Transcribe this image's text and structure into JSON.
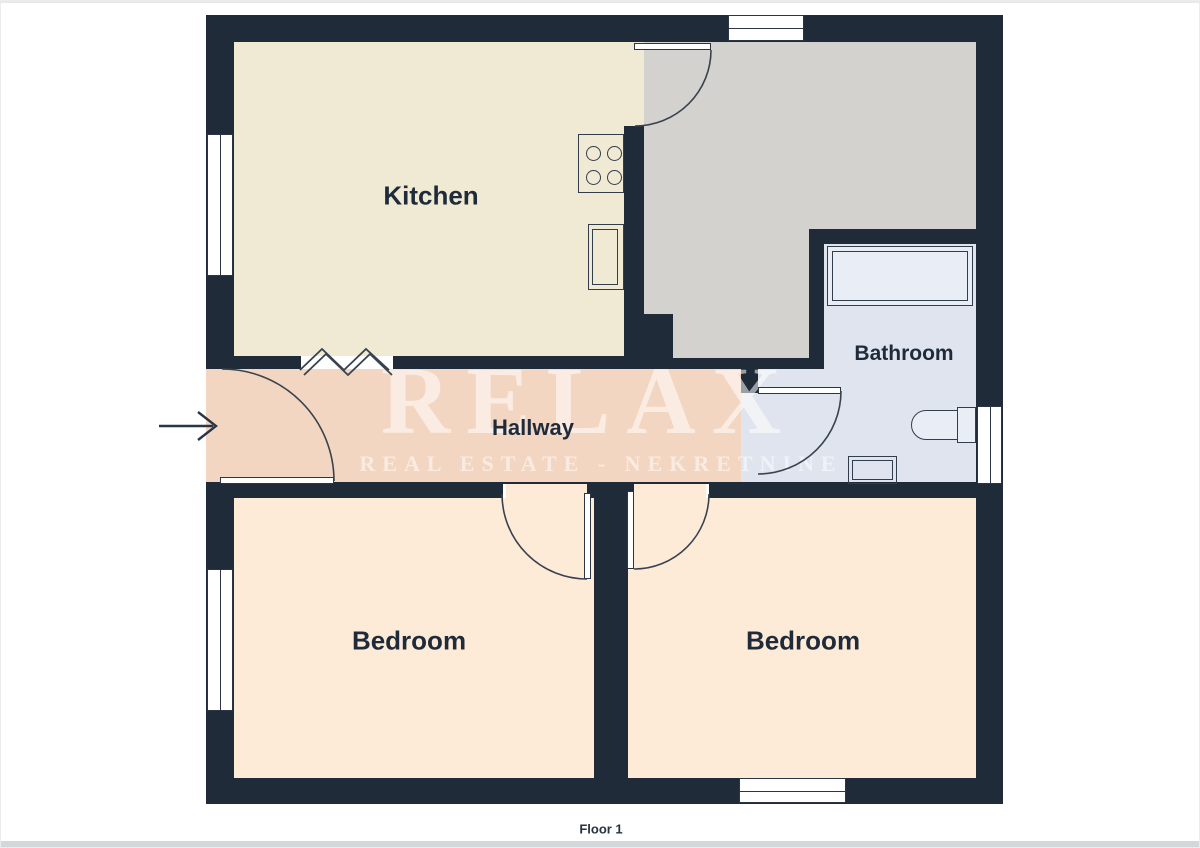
{
  "page": {
    "floor_label": "Floor 1"
  },
  "watermark": {
    "title": "RELAX",
    "subtitle": "REAL ESTATE - NEKRETNINE"
  },
  "rooms": {
    "kitchen": {
      "label": "Kitchen"
    },
    "bathroom": {
      "label": "Bathroom"
    },
    "hallway": {
      "label": "Hallway"
    },
    "bedroom_left": {
      "label": "Bedroom"
    },
    "bedroom_right": {
      "label": "Bedroom"
    }
  },
  "fixtures": [
    "stove",
    "kitchen-sink",
    "bathtub",
    "toilet",
    "bathroom-sink"
  ],
  "symbols": [
    "entry-arrow",
    "door-swing-arc",
    "window",
    "wall-opening-zigzag"
  ],
  "colors": {
    "wall": "#202b39",
    "kitchen_floor": "#f0e9d3",
    "gray_room_floor": "#d3d2ce",
    "bathroom_floor": "#dfe4ee",
    "bathtub_fill": "#e9edf5",
    "hallway_floor": "#f3d6c1",
    "bedroom_floor": "#fdebd8",
    "label_text": "#1f2b3a",
    "outline": "#39434f",
    "page_strip": "#d5d8db"
  }
}
